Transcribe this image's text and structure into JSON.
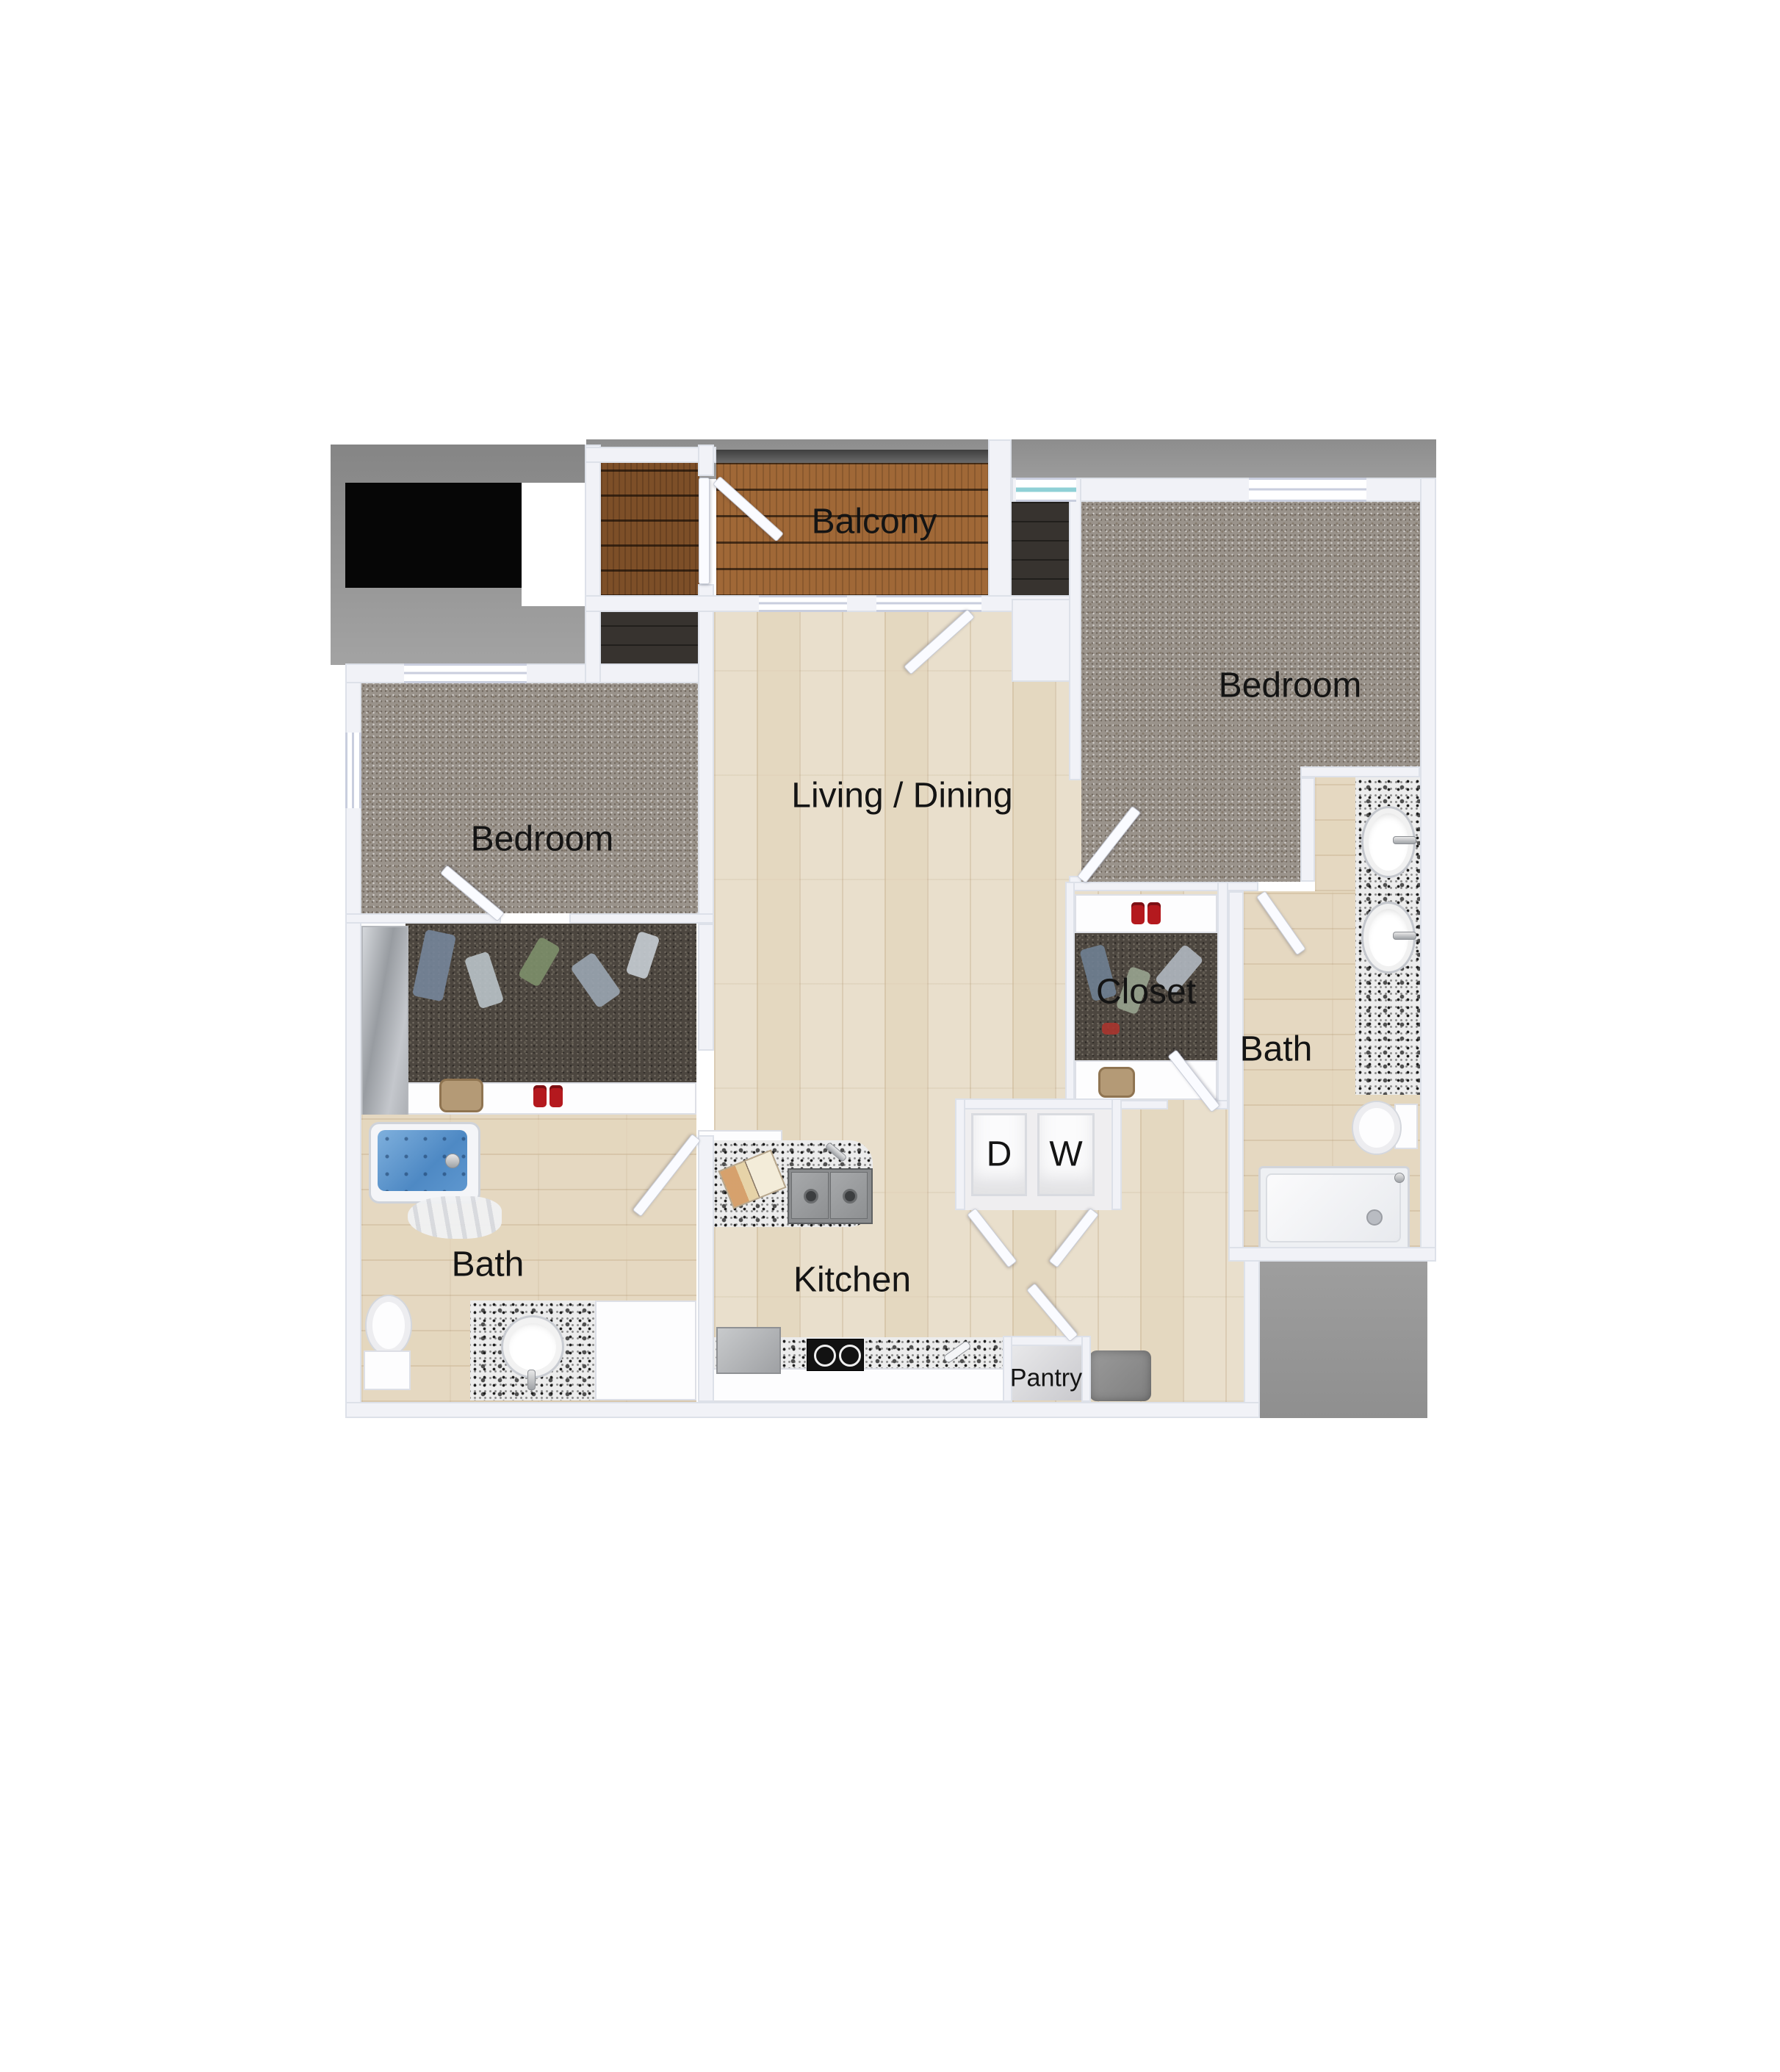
{
  "plan": {
    "type": "apartment-floor-plan",
    "labels": {
      "balcony": "Balcony",
      "bedroom_right": "Bedroom",
      "bedroom_left": "Bedroom",
      "living": "Living / Dining",
      "closet": "Closet",
      "bath_right": "Bath",
      "bath_left": "Bath",
      "kitchen": "Kitchen",
      "pantry": "Pantry",
      "dryer": "D",
      "washer": "W"
    },
    "palette": {
      "wall": "#f1f2f7",
      "wall_edge": "#c5cbd8",
      "carpet": "#9a938b",
      "closet_carpet": "#4c463f",
      "wood_floor": "#e9dfcc",
      "balcony_deck": "#a06837",
      "storage_deck": "#7d4f28",
      "granite": "#ececec",
      "tub_water": "#5b9ad1",
      "outdoor_gray": "#909090",
      "black_area": "#060606",
      "label_text": "#141414",
      "door_leaf": "#fafbff",
      "mat_gray": "#8d8d8d"
    }
  }
}
